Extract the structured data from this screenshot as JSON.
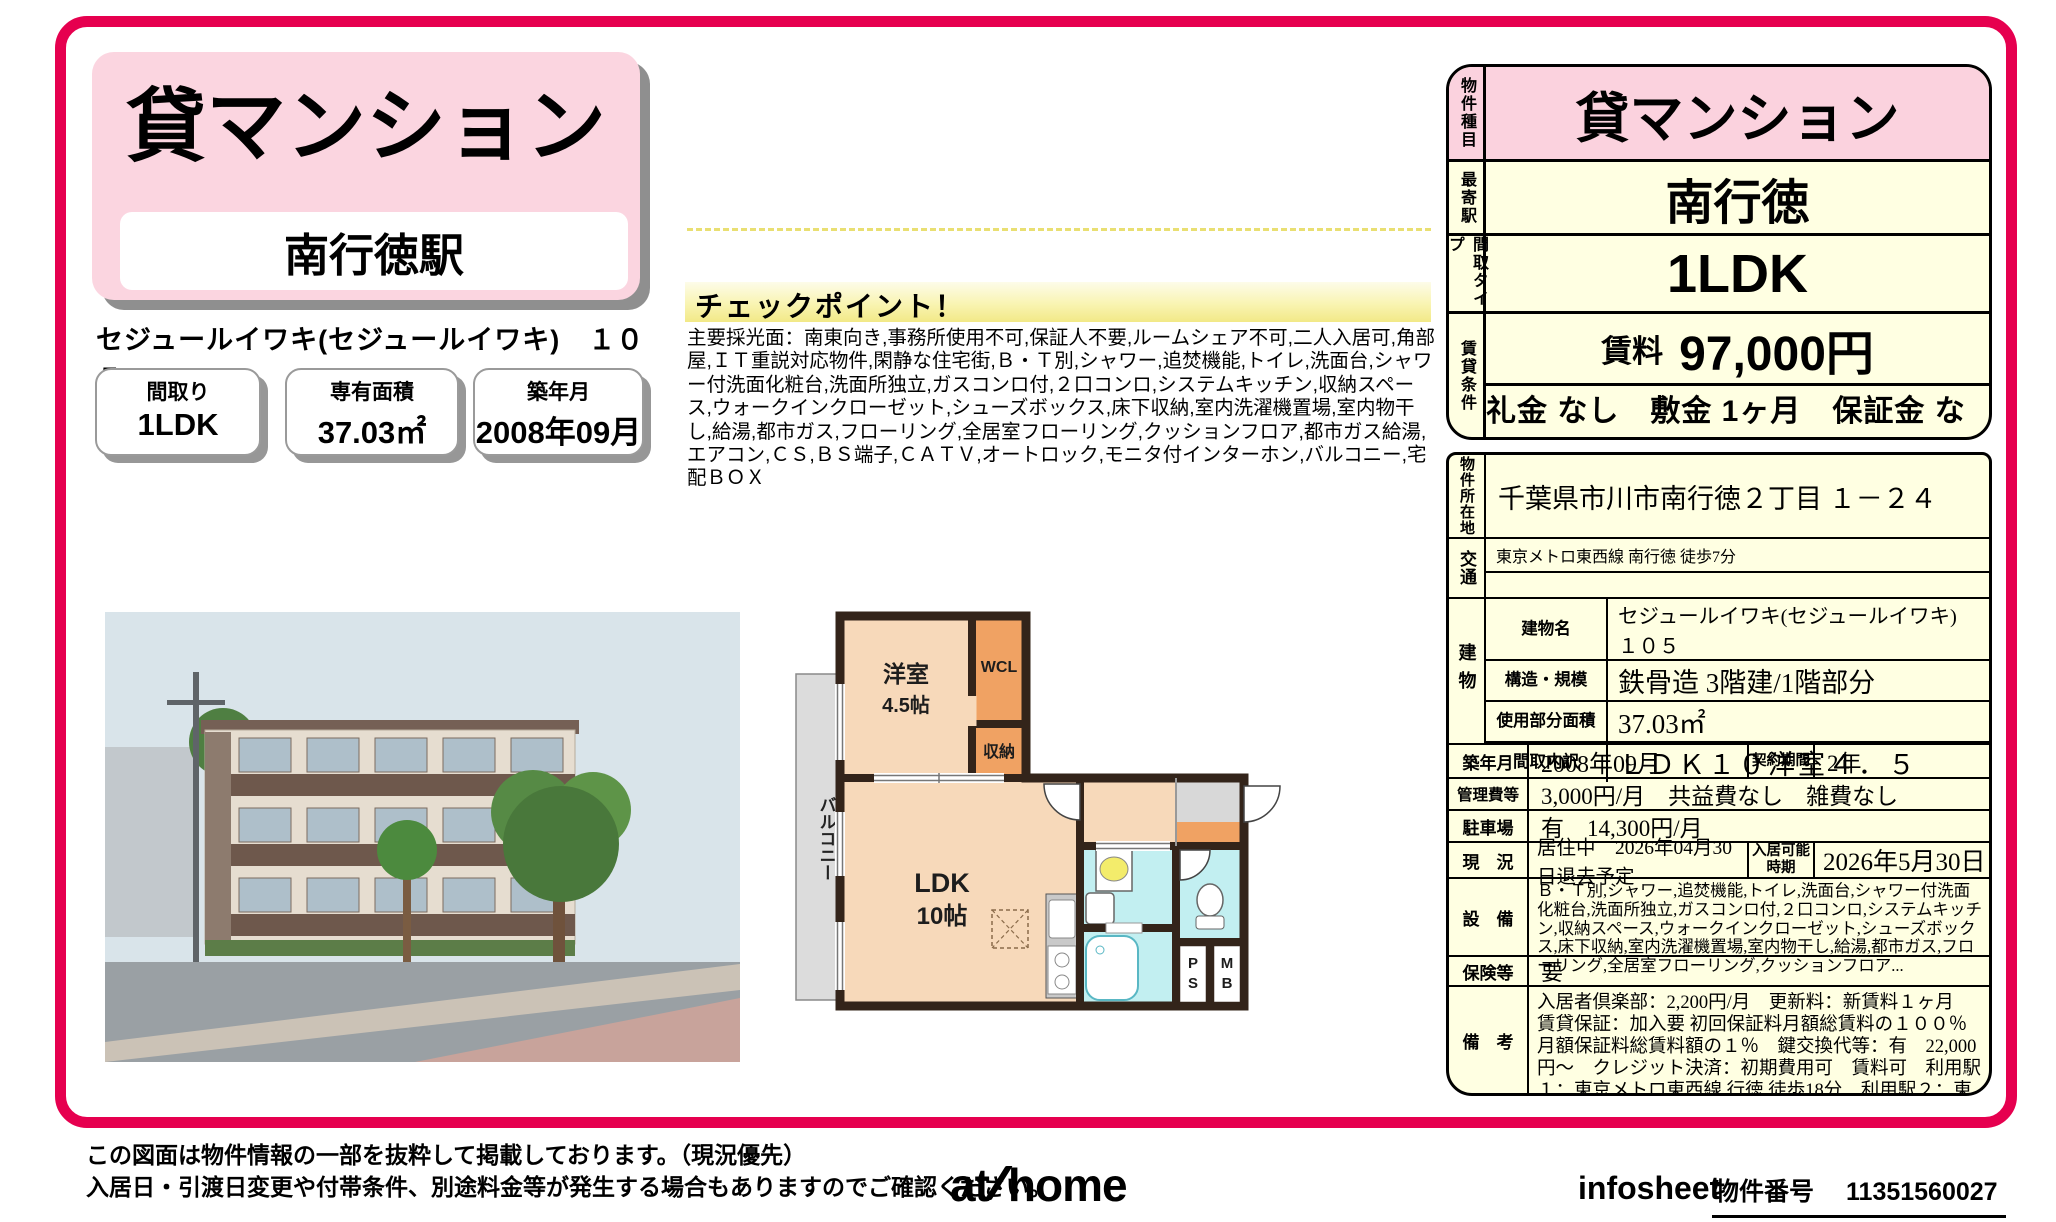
{
  "colors": {
    "accent": "#e6004f",
    "panel_pink": "#fbd2de",
    "panel_cream": "#ffffe2",
    "checkpoint_yellow": "#f2e987",
    "wall": "#33241a",
    "room_peach": "#f7d9ba",
    "closet_orange": "#f0a263",
    "water_cyan": "#c2eff1",
    "balcony_gray": "#dcdcdc"
  },
  "header": {
    "property_type": "貸マンション",
    "station": "南行徳駅",
    "property_name": "セジュールイワキ(セジュールイワキ)　１０５",
    "stats": [
      {
        "label": "間取り",
        "value": "1LDK"
      },
      {
        "label": "専有面積",
        "value": "37.03㎡"
      },
      {
        "label": "築年月",
        "value": "2008年09月"
      }
    ]
  },
  "checkpoint": {
    "title": "チェックポイント！",
    "body": "主要採光面：南東向き,事務所使用不可,保証人不要,ルームシェア不可,二人入居可,角部屋,ＩＴ重説対応物件,閑静な住宅街,Ｂ・Ｔ別,シャワー,追焚機能,トイレ,洗面台,シャワー付洗面化粧台,洗面所独立,ガスコンロ付,２口コンロ,システムキッチン,収納スペース,ウォークインクローゼット,シューズボックス,床下収納,室内洗濯機置場,室内物干し,給湯,都市ガス,フローリング,全居室フローリング,クッションフロア,都市ガス給湯,エアコン,ＣＳ,ＢＳ端子,ＣＡＴＶ,オートロック,モニタ付インターホン,バルコニー,宅配ＢＯＸ"
  },
  "summary_table": {
    "rows": [
      {
        "label": "物件種目",
        "value": "貸マンション"
      },
      {
        "label": "最寄駅",
        "value": "南行徳"
      },
      {
        "label": "間取タイプ",
        "value": "1LDK"
      },
      {
        "label": "賃貸条件",
        "rent_label": "賃料",
        "rent_value": "97,000円",
        "terms": "礼金 なし　敷金 1ヶ月　保証金 なし"
      }
    ]
  },
  "detail_table": {
    "location_label": "物件所在地",
    "location": "千葉県市川市南行徳２丁目 １－２４",
    "access_label": "交通",
    "access": "東京メトロ東西線 南行徳 徒歩7分",
    "building_label": "建物",
    "building_rows": [
      {
        "label": "建物名",
        "value": "セジュールイワキ(セジュールイワキ)　１０５"
      },
      {
        "label": "構造・規模",
        "value": "鉄骨造 3階建/1階部分"
      },
      {
        "label": "使用部分面積",
        "value": "37.03㎡"
      },
      {
        "label": "間取内訳",
        "value": "ＬＤＫ１０洋室４．５"
      }
    ],
    "built_label": "築年月",
    "built": "2008年09月",
    "contract_label": "契約期間",
    "contract": "2年",
    "fee_label": "管理費等",
    "fee": "3,000円/月　共益費なし　雑費なし",
    "parking_label": "駐車場",
    "parking": "有　14,300円/月",
    "status_label": "現　況",
    "status": "居住中　2026年04月30日退去予定",
    "available_label": "入居可能時期",
    "available": "2026年5月30日",
    "equipment_label": "設　備",
    "equipment": "Ｂ・Ｔ別,シャワー,追焚機能,トイレ,洗面台,シャワー付洗面化粧台,洗面所独立,ガスコンロ付,２口コンロ,システムキッチン,収納スペース,ウォークインクローゼット,シューズボックス,床下収納,室内洗濯機置場,室内物干し,給湯,都市ガス,フローリング,全居室フローリング,クッションフロア...",
    "insurance_label": "保険等",
    "insurance": "要",
    "notes_label": "備　考",
    "notes": "入居者倶楽部：2,200円/月　更新料：新賃料１ヶ月　賃貸保証：加入要 初回保証料月額総賃料の１００％　月額保証料総賃料額の１％　鍵交換代等：有　22,000円～　クレジット決済：初期費用可　賃料可　利用駅１：東京メトロ東西線 行徳 徒歩18分　利用駅２：東京メトロ東西線 浦安 徒歩22分"
  },
  "floorplan": {
    "balcony": "バルコニー",
    "room1_name": "洋室",
    "room1_size": "4.5帖",
    "wcl": "WCL",
    "storage": "収納",
    "ldk_name": "LDK",
    "ldk_size": "10帖",
    "ps_line1": "P",
    "ps_line2": "S",
    "mb_line1": "M",
    "mb_line2": "B"
  },
  "footer": {
    "disclaimer_line1": "この図面は物件情報の一部を抜粋して掲載しております。（現況優先）",
    "disclaimer_line2": "入居日・引渡日変更や付帯条件、別途料金等が発生する場合もありますのでご確認ください。",
    "logo_at": "at",
    "logo_home": "home",
    "brand": "infosheet",
    "property_no_label": "物件番号",
    "property_no": "11351560027"
  }
}
